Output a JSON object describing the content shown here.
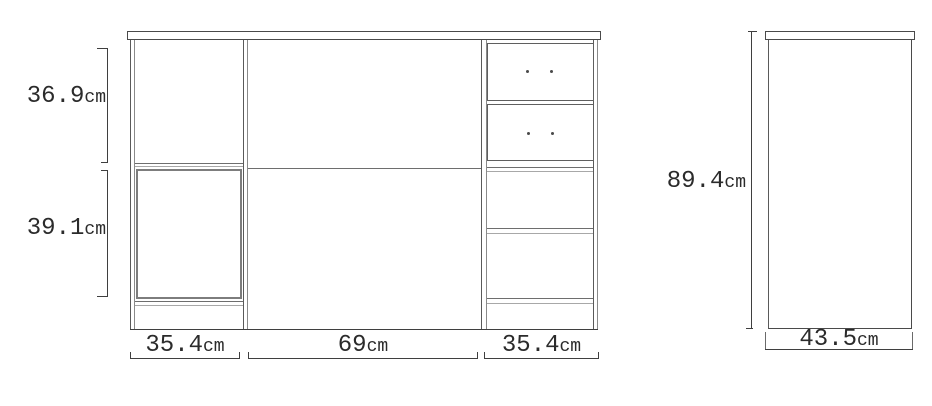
{
  "diagram": {
    "kind": "furniture-dimension-drawing",
    "unit": "cm",
    "dimensions": {
      "front_upper_height": "36.9",
      "front_lower_height": "39.1",
      "front_left_width": "35.4",
      "front_center_width": "69",
      "front_right_width": "35.4",
      "side_height": "89.4",
      "side_depth": "43.5"
    },
    "colors": {
      "line_dark": "#3f3f3f",
      "line_mid": "#6e6e6e",
      "line_light": "#a8a8a8",
      "door_border": "#7d7d7d",
      "drawer_border": "#5f5f5f",
      "text": "#2b2b2b",
      "background": "#ffffff"
    }
  }
}
